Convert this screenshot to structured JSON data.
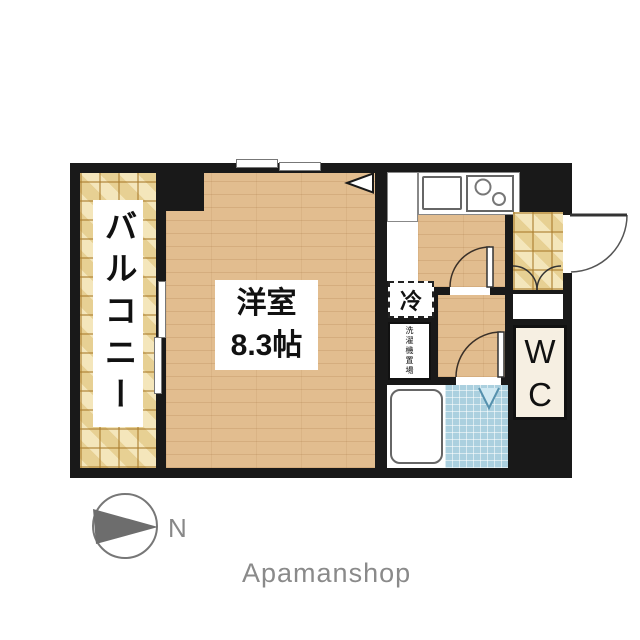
{
  "floorplan": {
    "balcony": {
      "label": "バルコニー"
    },
    "main_room": {
      "name": "洋室",
      "size": "8.3帖"
    },
    "kitchen": {
      "fridge_label": "冷",
      "laundry_label": "洗濯機置場"
    },
    "wc": {
      "letters": [
        "W",
        "C"
      ]
    },
    "compass": {
      "north_label": "N"
    },
    "brand": "Apamanshop",
    "colors": {
      "wall": "#191919",
      "wood_floor": "#e2bd8f",
      "balcony_tile": "#eedcab",
      "bathroom_tile": "#abd0df",
      "wc_fill": "#f6efe2",
      "compass_gray": "#777777",
      "brand_gray": "#8a8a8a"
    }
  }
}
